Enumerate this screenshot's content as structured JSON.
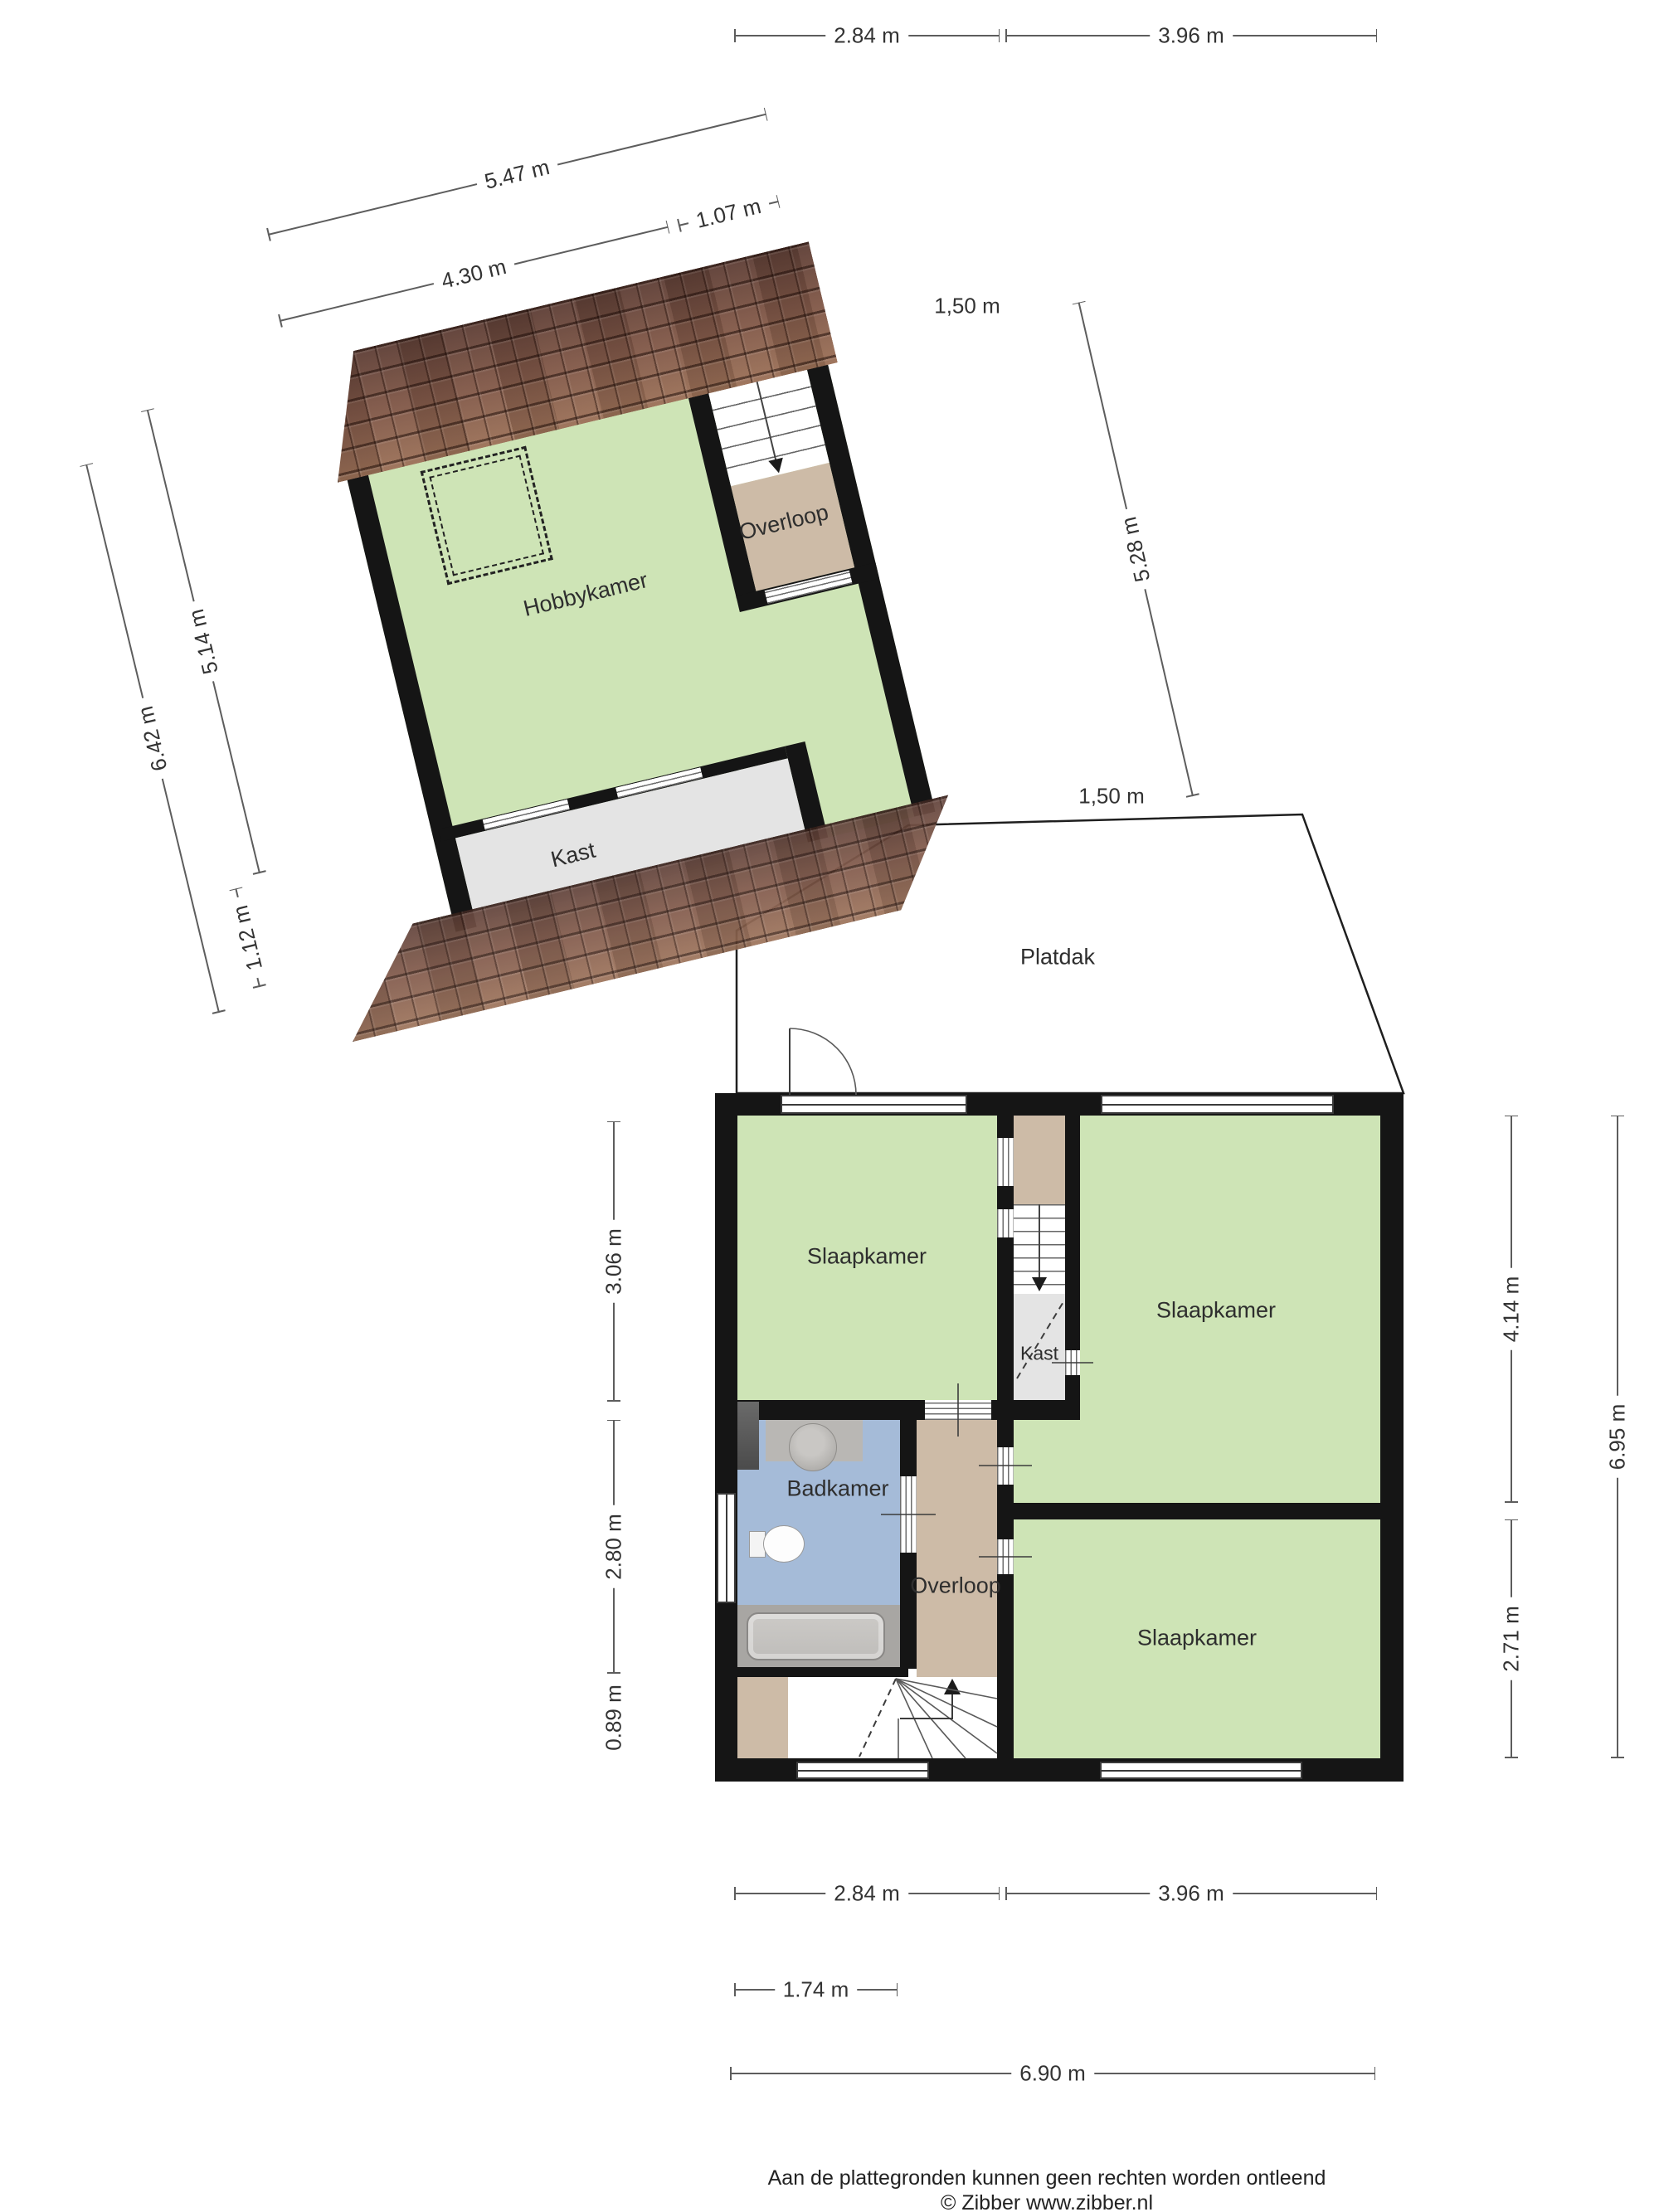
{
  "document": {
    "kind": "floorplan"
  },
  "attic": {
    "rooms": {
      "hobbykamer": "Hobbykamer",
      "overloop": "Overloop",
      "kast": "Kast"
    }
  },
  "first_floor": {
    "rooms": {
      "slaapkamer_left": "Slaapkamer",
      "slaapkamer_right": "Slaapkamer",
      "slaapkamer_bottom": "Slaapkamer",
      "badkamer": "Badkamer",
      "overloop": "Overloop",
      "kast": "Kast"
    },
    "roof": "Platdak"
  },
  "dimensions": {
    "lines": [
      {
        "id": "top_284",
        "label": "2.84 m"
      },
      {
        "id": "top_396",
        "label": "3.96 m"
      },
      {
        "id": "attic_547",
        "label": "5.47 m"
      },
      {
        "id": "attic_430",
        "label": "4.30 m"
      },
      {
        "id": "attic_107",
        "label": "1.07 m"
      },
      {
        "id": "attic_642",
        "label": "6.42 m"
      },
      {
        "id": "attic_514",
        "label": "5.14 m"
      },
      {
        "id": "attic_112",
        "label": "1.12 m"
      },
      {
        "id": "attic_528",
        "label": "5.28 m"
      },
      {
        "id": "left_306",
        "label": "3.06 m"
      },
      {
        "id": "left_280",
        "label": "2.80 m"
      },
      {
        "id": "left_089",
        "label": "0.89 m"
      },
      {
        "id": "right_414",
        "label": "4.14 m"
      },
      {
        "id": "right_271",
        "label": "2.71 m"
      },
      {
        "id": "right_695",
        "label": "6.95 m"
      },
      {
        "id": "bottom_284",
        "label": "2.84 m"
      },
      {
        "id": "bottom_396",
        "label": "3.96 m"
      },
      {
        "id": "bottom_174",
        "label": "1.74 m"
      },
      {
        "id": "bottom_690",
        "label": "6.90 m"
      }
    ],
    "free_labels": [
      {
        "id": "knee_top",
        "label": "1,50 m"
      },
      {
        "id": "knee_bottom",
        "label": "1,50 m"
      }
    ]
  },
  "footer": {
    "disclaimer": "Aan de plattegronden kunnen geen rechten worden ontleend",
    "copyright": "© Zibber www.zibber.nl"
  },
  "colors": {
    "room_green": "#cee4b6",
    "hall_tan": "#cdbba7",
    "bath_blue": "#a5bbd8",
    "closet_grey": "#e4e4e4",
    "wall_black": "#151515",
    "roof_brown": "#7d5546"
  }
}
